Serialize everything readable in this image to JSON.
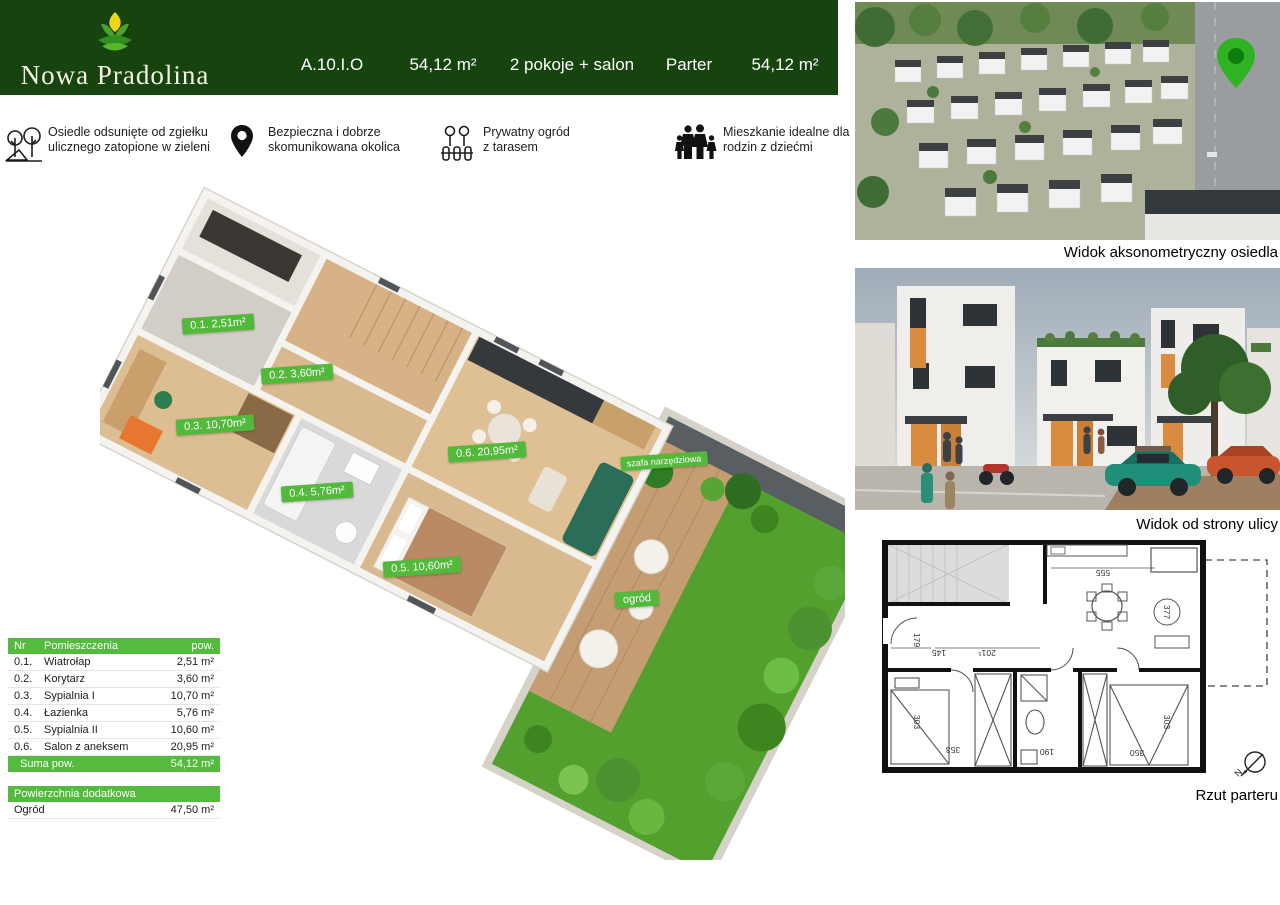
{
  "header": {
    "brand": "Nowa Pradolina",
    "unit_code": "A.10.I.O",
    "area": "54,12 m²",
    "rooms": "2 pokoje + salon",
    "floor": "Parter",
    "area_right": "54,12 m²"
  },
  "features": [
    {
      "icon": "trees-icon",
      "line1": "Osiedle odsunięte od zgiełku",
      "line2": "ulicznego zatopione w zieleni"
    },
    {
      "icon": "location-pin-icon",
      "line1": "Bezpieczna i dobrze",
      "line2": "skomunikowana okolica"
    },
    {
      "icon": "garden-fence-icon",
      "line1": "Prywatny ogród",
      "line2": "z tarasem"
    },
    {
      "icon": "family-icon",
      "line1": "Mieszkanie idealne dla",
      "line2": "rodzin z dziećmi"
    }
  ],
  "plan_labels": [
    {
      "text": "0.1. 2,51m²"
    },
    {
      "text": "0.2. 3,60m²"
    },
    {
      "text": "0.3. 10,70m²"
    },
    {
      "text": "0.4. 5,76m²"
    },
    {
      "text": "0.5. 10,60m²"
    },
    {
      "text": "0.6. 20,95m²"
    },
    {
      "text": "szafa narzędziowa"
    },
    {
      "text": "ogród"
    }
  ],
  "rooms_table": {
    "header": {
      "nr": "Nr",
      "name": "Pomieszczenia",
      "area": "pow."
    },
    "rows": [
      {
        "nr": "0.1.",
        "name": "Wiatrołap",
        "area": "2,51 m²"
      },
      {
        "nr": "0.2.",
        "name": "Korytarz",
        "area": "3,60 m²"
      },
      {
        "nr": "0.3.",
        "name": "Sypialnia I",
        "area": "10,70 m²"
      },
      {
        "nr": "0.4.",
        "name": "Łazienka",
        "area": "5,76 m²"
      },
      {
        "nr": "0.5.",
        "name": "Sypialnia II",
        "area": "10,60 m²"
      },
      {
        "nr": "0.6.",
        "name": "Salon z aneksem",
        "area": "20,95 m²"
      }
    ],
    "total": {
      "label": "Suma pow.",
      "area": "54,12 m²"
    },
    "extra_header": "Powierzchnia dodatkowa",
    "extra_row": {
      "name": "Ogród",
      "area": "47,50 m²"
    }
  },
  "captions": {
    "aerial": "Widok aksonometryczny osiedla",
    "street": "Widok od strony ulicy",
    "plan2d": "Rzut parteru"
  },
  "plan2d": {
    "dims": [
      "555",
      "377",
      "179",
      "145",
      "201⁵",
      "303",
      "353",
      "190",
      "350",
      "303"
    ],
    "north": "N"
  },
  "colors": {
    "header_green": "#17430e",
    "accent_green": "#55bb3f",
    "pill_green": "#52b93a",
    "pin_green": "#2fb322",
    "lawn_green": "#53a02e"
  }
}
